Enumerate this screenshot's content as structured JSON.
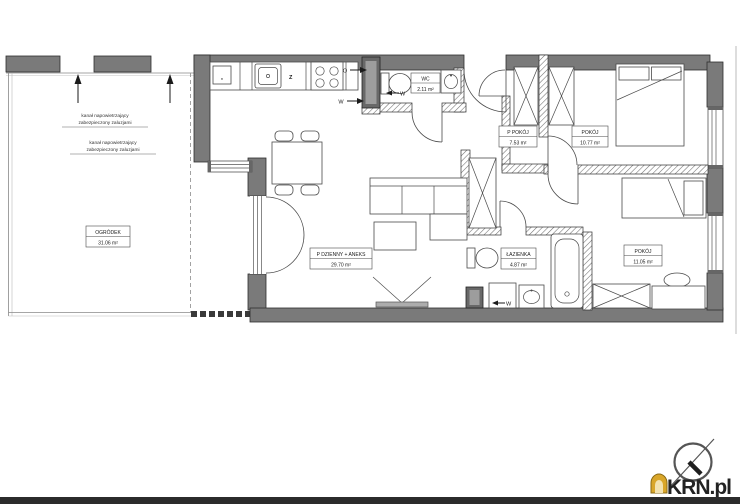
{
  "plan": {
    "garden": {
      "name": "OGRÓDEK",
      "area": "31.06 m²"
    },
    "living": {
      "name": "P DZIENNY + ANEKS",
      "area": "29.70 m²"
    },
    "wc": {
      "name": "WC",
      "area": "2.11 m²"
    },
    "small_room": {
      "name": "P POKÓJ",
      "area": "7.53 m²"
    },
    "bedroom1": {
      "name": "POKÓJ",
      "area": "10.77 m²"
    },
    "bathroom": {
      "name": "ŁAZIENKA",
      "area": "4.87 m²"
    },
    "bedroom2": {
      "name": "POKÓJ",
      "area": "11.05 m²"
    },
    "vent_note1": {
      "line1": "kanał napowietrzający",
      "line2": "zabezpieczony zaluzjami"
    },
    "vent_note2": {
      "line1": "kanał napowietrzający",
      "line2": "zabezpieczony zaluzjami"
    },
    "marks": {
      "fridge": "*",
      "sink_z": "Z",
      "gas_o": "O",
      "water_w": "W",
      "wc_w": "W",
      "wash_w": "W"
    }
  },
  "branding": {
    "logo": "KRN.pl"
  },
  "colors": {
    "wall_gray": "#7a7a7a",
    "footer_bar": "#2b2b2b",
    "logo_gold": "#d9a62a",
    "logo_gray": "#7c7c7c"
  }
}
